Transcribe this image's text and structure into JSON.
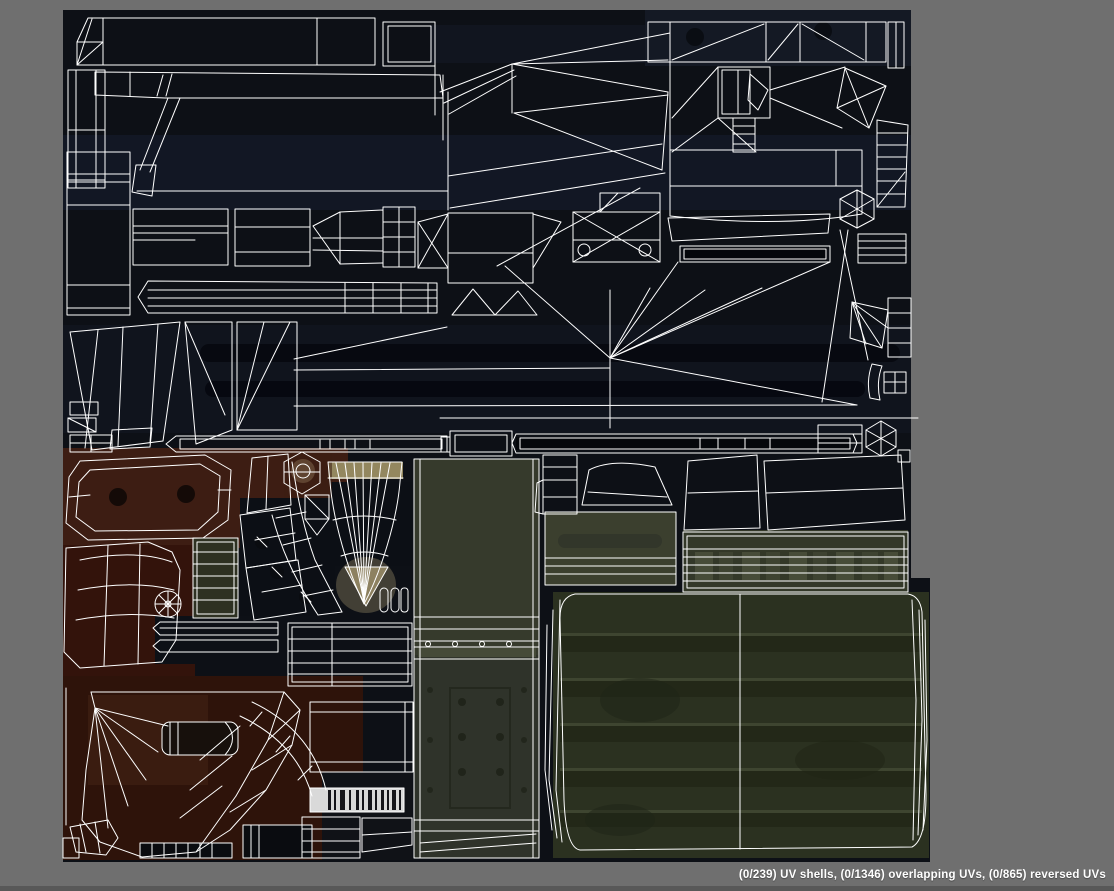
{
  "window": {
    "title": "UV Editor viewport",
    "background_color": "#6f6f6f"
  },
  "status_bar": {
    "text": "(0/239) UV shells, (0/1346) overlapping UVs, (0/865) reversed UVs",
    "uv_shells_count": "0/239",
    "overlapping_uvs_count": "0/1346",
    "reversed_uvs_count": "0/865",
    "text_color": "#ffffff"
  },
  "canvas": {
    "description": "UV layout of a weapon texture atlas: white wireframe UV shells over dark texture",
    "wireframe_color": "#ffffff",
    "palette": {
      "texture_base_navy": "#0d1016",
      "texture_navy_light": "#141924",
      "texture_rust_red": "#3d1d13",
      "texture_rust_dark": "#2e130a",
      "texture_olive_door": "#363a2c",
      "texture_olive_tarp": "#2b3120",
      "texture_tan": "#93875f",
      "texture_bronze": "#8a7254",
      "barcode_white": "#d9d9d9"
    }
  }
}
